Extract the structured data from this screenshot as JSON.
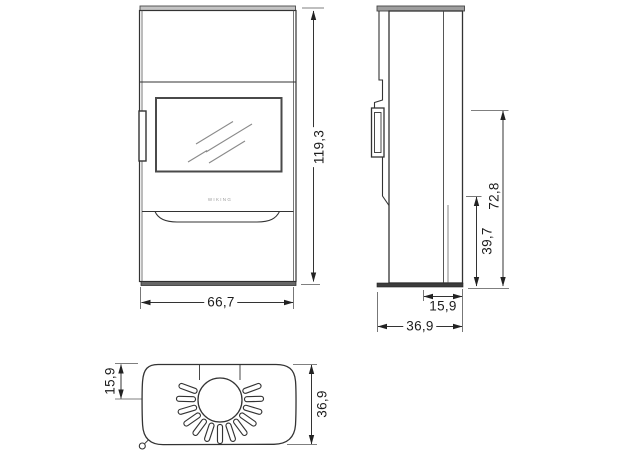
{
  "drawing": {
    "product_logo": "WIKING",
    "dimensions": {
      "front_height": "119,3",
      "front_width": "66,7",
      "side_rear_offset": "15,9",
      "side_depth": "36,9",
      "side_height_lower": "39,7",
      "side_height_upper": "72,8",
      "top_flue_offset": "15,9",
      "top_depth": "36,9"
    },
    "colors": {
      "line": "#333333",
      "dim_line": "#444444",
      "dim_text": "#1d1d1d",
      "front_cap_fill": "#c4c4c4",
      "side_cap_fill": "#9e9e9e",
      "front_base_fill": "#666666",
      "side_base_fill": "#3c3c3c",
      "glass_reflection": "#8a8a8a"
    }
  }
}
